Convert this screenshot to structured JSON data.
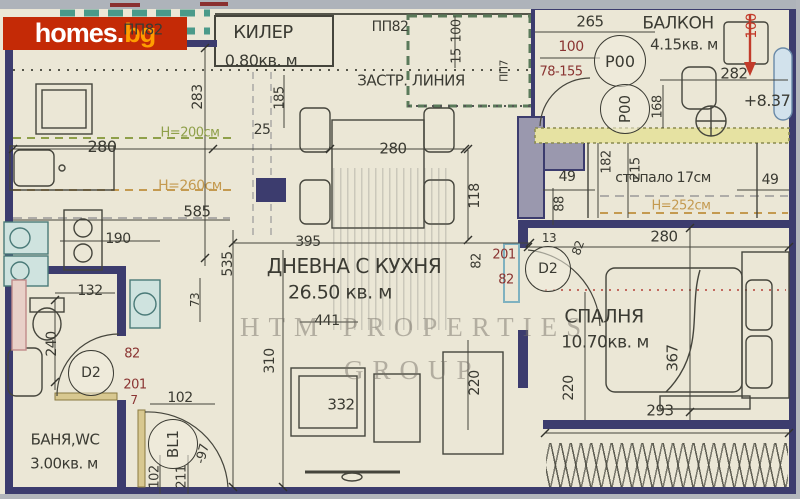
{
  "logo": {
    "main": "homes",
    "dot": ".",
    "suffix": "bg"
  },
  "watermark": {
    "line1": "HTM PROPERTIES",
    "line2": "GROUP"
  },
  "colors": {
    "paper": "#ebe7d6",
    "wall": "#3c3c6e",
    "thin_line": "#45453c",
    "dim_red": "#8a3432",
    "bright_red": "#c23b2a",
    "height_green": "#8fa04a",
    "height_orange": "#c49a50",
    "fixture_teal": "#cfe3df",
    "logo_bg": "#c42a06",
    "logo_accent": "#ff9d00"
  },
  "rooms": [
    {
      "name": "КИЛЕР",
      "area": "0.80кв. м"
    },
    {
      "name": "БАЛКОН",
      "area": "4.15кв. м"
    },
    {
      "name": "ДНЕВНА С КУХНЯ",
      "area": "26.50 кв. м"
    },
    {
      "name": "СПАЛНЯ",
      "area": "10.70кв. м"
    },
    {
      "name": "БАНЯ,WC",
      "area": "3.00кв. м"
    }
  ],
  "labels": [
    {
      "name": "room-kiler-label",
      "t": "КИЛЕР",
      "x": 263,
      "y": 33,
      "fs": 18,
      "cls": "room"
    },
    {
      "name": "room-kiler-area",
      "t": "0.80кв. м",
      "x": 261,
      "y": 61,
      "fs": 16,
      "cls": "room"
    },
    {
      "name": "pp82-left-label",
      "t": "ПП82",
      "x": 143,
      "y": 30,
      "fs": 15,
      "cls": "room"
    },
    {
      "name": "pp82-right-label",
      "t": "ПП82",
      "x": 390,
      "y": 27,
      "fs": 14,
      "cls": "room"
    },
    {
      "name": "zastr-linia-label",
      "t": "ЗАСТР. ЛИНИЯ",
      "x": 411,
      "y": 81,
      "fs": 15,
      "cls": "room"
    },
    {
      "name": "pp7-label",
      "t": "ПП7",
      "x": 504,
      "y": 71,
      "fs": 11,
      "rot": -90,
      "cls": "room"
    },
    {
      "name": "room-balkon-label",
      "t": "БАЛКОН",
      "x": 678,
      "y": 24,
      "fs": 17,
      "cls": "room"
    },
    {
      "name": "room-balkon-area",
      "t": "4.15кв. м",
      "x": 684,
      "y": 45,
      "fs": 15,
      "cls": "room"
    },
    {
      "name": "elevation-label",
      "t": "+8.37",
      "x": 767,
      "y": 101,
      "fs": 16,
      "cls": "room"
    },
    {
      "name": "stair-note",
      "t": "стъпало 17см",
      "x": 663,
      "y": 178,
      "fs": 14,
      "cls": "room"
    },
    {
      "name": "height-252",
      "t": "Н=252см",
      "x": 681,
      "y": 206,
      "fs": 13,
      "cls": "orange"
    },
    {
      "name": "height-200",
      "t": "Н=200см",
      "x": 190,
      "y": 133,
      "fs": 13,
      "cls": "green"
    },
    {
      "name": "height-260",
      "t": "Н=260см",
      "x": 190,
      "y": 186,
      "fs": 14,
      "cls": "orange"
    },
    {
      "name": "room-living-label",
      "t": "ДНЕВНА С КУХНЯ",
      "x": 354,
      "y": 266,
      "fs": 20,
      "cls": "room"
    },
    {
      "name": "room-living-area",
      "t": "26.50 кв. м",
      "x": 340,
      "y": 293,
      "fs": 19,
      "cls": "room"
    },
    {
      "name": "room-bedroom-label",
      "t": "СПАЛНЯ",
      "x": 604,
      "y": 317,
      "fs": 19,
      "cls": "room"
    },
    {
      "name": "room-bedroom-area",
      "t": "10.70кв. м",
      "x": 605,
      "y": 343,
      "fs": 17,
      "cls": "room"
    },
    {
      "name": "room-bath-label",
      "t": "БАНЯ,WC",
      "x": 65,
      "y": 440,
      "fs": 15,
      "cls": "room"
    },
    {
      "name": "room-bath-area",
      "t": "3.00кв. м",
      "x": 64,
      "y": 464,
      "fs": 15,
      "cls": "room"
    },
    {
      "t": "265",
      "x": 590,
      "y": 22,
      "fs": 15
    },
    {
      "t": "100",
      "x": 571,
      "y": 47,
      "fs": 14,
      "cls": "red"
    },
    {
      "t": "78-155",
      "x": 561,
      "y": 72,
      "fs": 13,
      "cls": "red"
    },
    {
      "t": "282",
      "x": 734,
      "y": 74,
      "fs": 15
    },
    {
      "t": "168",
      "x": 658,
      "y": 107,
      "fs": 13,
      "rot": -90
    },
    {
      "t": "100",
      "x": 752,
      "y": 26,
      "fs": 14,
      "rot": -90,
      "cls": "bred"
    },
    {
      "t": "100",
      "x": 457,
      "y": 31,
      "fs": 13,
      "rot": -90
    },
    {
      "t": "15",
      "x": 457,
      "y": 56,
      "fs": 13,
      "rot": -90
    },
    {
      "t": "283",
      "x": 198,
      "y": 97,
      "fs": 14,
      "rot": -90
    },
    {
      "t": "185",
      "x": 280,
      "y": 98,
      "fs": 13,
      "rot": -90
    },
    {
      "t": "25",
      "x": 262,
      "y": 130,
      "fs": 14
    },
    {
      "t": "280",
      "x": 102,
      "y": 147,
      "fs": 16
    },
    {
      "t": "280",
      "x": 393,
      "y": 149,
      "fs": 15
    },
    {
      "t": "118",
      "x": 475,
      "y": 196,
      "fs": 14,
      "rot": -90
    },
    {
      "t": "585",
      "x": 197,
      "y": 212,
      "fs": 15
    },
    {
      "t": "190",
      "x": 118,
      "y": 239,
      "fs": 14
    },
    {
      "t": "132",
      "x": 90,
      "y": 291,
      "fs": 14
    },
    {
      "t": "240",
      "x": 52,
      "y": 344,
      "fs": 14,
      "rot": -90
    },
    {
      "t": "535",
      "x": 228,
      "y": 264,
      "fs": 14,
      "rot": -90
    },
    {
      "t": "73",
      "x": 195,
      "y": 300,
      "fs": 12,
      "rot": -90
    },
    {
      "t": "395",
      "x": 308,
      "y": 242,
      "fs": 14
    },
    {
      "t": "310",
      "x": 270,
      "y": 361,
      "fs": 14,
      "rot": -90
    },
    {
      "t": "332",
      "x": 341,
      "y": 405,
      "fs": 15
    },
    {
      "t": "441",
      "x": 327,
      "y": 321,
      "fs": 14
    },
    {
      "t": "220",
      "x": 475,
      "y": 383,
      "fs": 14,
      "rot": -90
    },
    {
      "t": "220",
      "x": 569,
      "y": 388,
      "fs": 14,
      "rot": -90
    },
    {
      "t": "367",
      "x": 673,
      "y": 358,
      "fs": 15,
      "rot": -90
    },
    {
      "t": "293",
      "x": 660,
      "y": 411,
      "fs": 15
    },
    {
      "t": "280",
      "x": 664,
      "y": 237,
      "fs": 15
    },
    {
      "t": "49",
      "x": 567,
      "y": 177,
      "fs": 14
    },
    {
      "t": "49",
      "x": 770,
      "y": 180,
      "fs": 14
    },
    {
      "t": "88",
      "x": 560,
      "y": 204,
      "fs": 13,
      "rot": -90
    },
    {
      "t": "182",
      "x": 607,
      "y": 162,
      "fs": 13,
      "rot": -90
    },
    {
      "t": "215",
      "x": 636,
      "y": 169,
      "fs": 13,
      "rot": -90
    },
    {
      "t": "13",
      "x": 549,
      "y": 238,
      "fs": 12
    },
    {
      "t": "82",
      "x": 578,
      "y": 248,
      "fs": 12,
      "rot": -70
    },
    {
      "t": "201",
      "x": 504,
      "y": 255,
      "fs": 13,
      "cls": "red"
    },
    {
      "t": "82",
      "x": 506,
      "y": 280,
      "fs": 13,
      "cls": "red"
    },
    {
      "t": "82",
      "x": 477,
      "y": 261,
      "fs": 13,
      "rot": -90
    },
    {
      "t": "82",
      "x": 132,
      "y": 354,
      "fs": 13,
      "cls": "red"
    },
    {
      "t": "201",
      "x": 135,
      "y": 385,
      "fs": 13,
      "cls": "red"
    },
    {
      "t": "7",
      "x": 134,
      "y": 400,
      "fs": 12,
      "cls": "red"
    },
    {
      "t": "102",
      "x": 180,
      "y": 398,
      "fs": 14
    },
    {
      "t": "-97",
      "x": 203,
      "y": 454,
      "fs": 13,
      "rot": -75
    },
    {
      "t": "102",
      "x": 155,
      "y": 477,
      "fs": 13,
      "rot": -90
    },
    {
      "t": "211",
      "x": 182,
      "y": 477,
      "fs": 13,
      "rot": -90
    }
  ],
  "markers": [
    {
      "t": "Р00",
      "x": 619,
      "y": 60,
      "r": 25
    },
    {
      "t": "Р00",
      "x": 624,
      "y": 108,
      "r": 24,
      "rot": -90
    },
    {
      "t": "D2",
      "x": 547,
      "y": 268,
      "r": 22
    },
    {
      "t": "D2",
      "x": 90,
      "y": 372,
      "r": 22
    },
    {
      "t": "BL1",
      "x": 172,
      "y": 443,
      "r": 24,
      "rot": -90
    }
  ]
}
